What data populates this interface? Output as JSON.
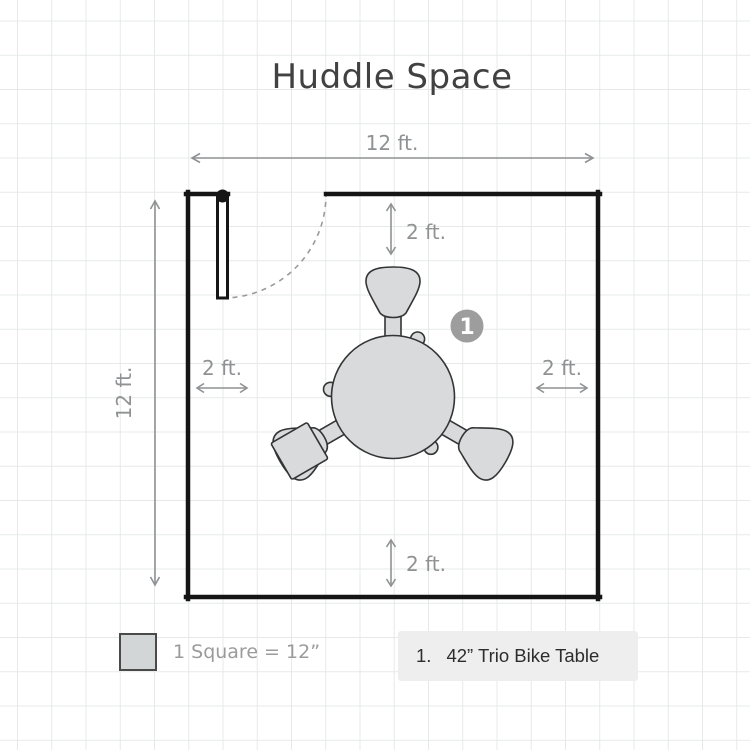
{
  "title": "Huddle Space",
  "room": {
    "width_label": "12 ft.",
    "height_label": "12 ft."
  },
  "clearances": {
    "top": "2 ft.",
    "bottom": "2 ft.",
    "left": "2 ft.",
    "right": "2 ft."
  },
  "furniture": {
    "badge_number": "1",
    "name": "42” Trio Bike Table"
  },
  "legend": {
    "scale_label": "1 Square = 12”",
    "item_number": "1.",
    "item_label": "42” Trio Bike Table"
  },
  "colors": {
    "wall": "#151515",
    "dimension_gray": "#8f9193",
    "grid_line": "#e7e8e8",
    "furniture_fill": "#d8dadb",
    "furniture_stroke": "#323435",
    "badge_gray": "#9d9d9d",
    "legend_box_bg": "#eeeeee",
    "title_color": "#414141"
  }
}
